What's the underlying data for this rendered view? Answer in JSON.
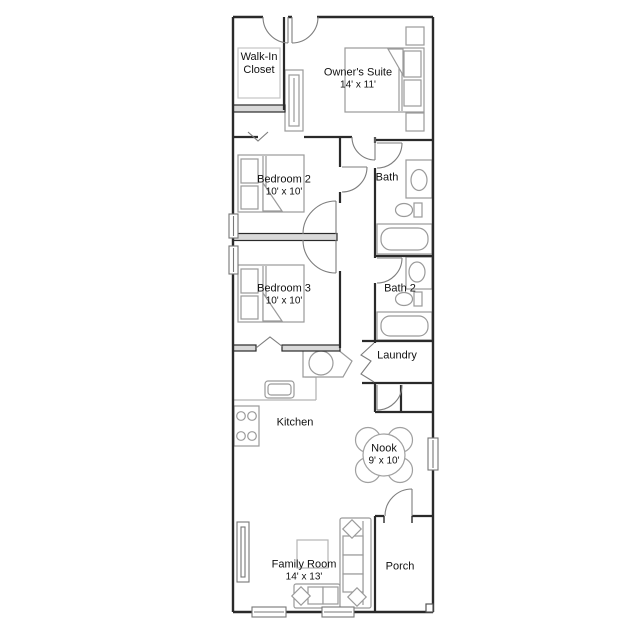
{
  "floor_plan": {
    "title": "Single family home floor plan",
    "rooms": {
      "walk_in_closet": {
        "label": "Walk-In Closet"
      },
      "owners_suite": {
        "label": "Owner's Suite",
        "dimensions": "14' x 11'"
      },
      "bedroom_2": {
        "label": "Bedroom 2",
        "dimensions": "10' x 10'"
      },
      "bath": {
        "label": "Bath"
      },
      "bedroom_3": {
        "label": "Bedroom 3",
        "dimensions": "10' x 10'"
      },
      "bath_2": {
        "label": "Bath 2"
      },
      "laundry": {
        "label": "Laundry"
      },
      "kitchen": {
        "label": "Kitchen"
      },
      "nook": {
        "label": "Nook",
        "dimensions": "9' x 10'"
      },
      "family_room": {
        "label": "Family Room",
        "dimensions": "14' x 13'"
      },
      "porch": {
        "label": "Porch"
      }
    },
    "colors": {
      "wall": "#2a2a2a",
      "fixture": "#9a9a9a",
      "light_detail": "#c0c0c0",
      "wall_fill": "#d9d9d9",
      "text": "#111111",
      "background": "#ffffff"
    }
  }
}
